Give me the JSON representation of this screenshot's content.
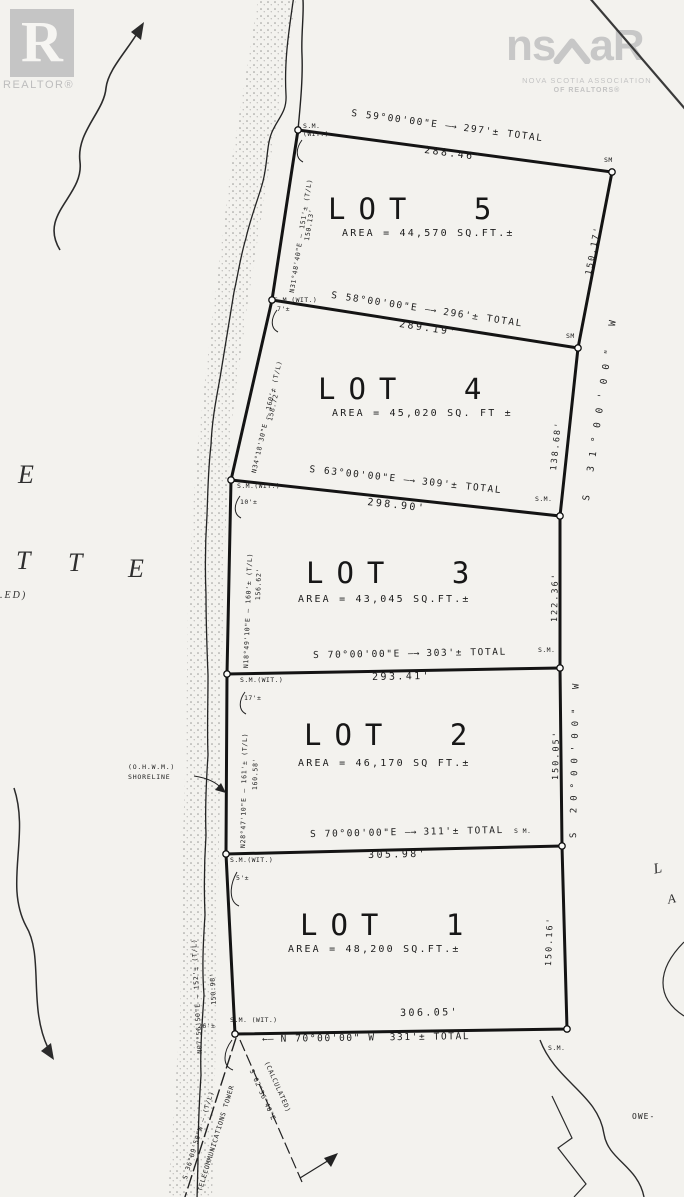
{
  "ui": {
    "arrow_right": "—→",
    "arrow_left": "←—"
  },
  "branding": {
    "realtor_letter": "R",
    "realtor_label": "REALTOR®",
    "nsar_left": "ns",
    "nsar_right": "aR",
    "nsar_line1": "NOVA SCOTIA ASSOCIATION",
    "nsar_line2": "OF REALTORS®"
  },
  "margin": {
    "e1": "E",
    "t1": "T",
    "t2": "T",
    "e2": "E",
    "ed": ".ED)",
    "l": "L",
    "a": "A",
    "owe": "OWE-"
  },
  "shoreline": {
    "line1": "(O.H.W.M.)",
    "line2": "SHORELINE"
  },
  "lots": [
    {
      "name": "LOT 5",
      "area": "AREA = 44,570 SQ.FT.±",
      "bearing": "S 59°00'00\"E",
      "total": "297'± TOTAL",
      "measured": "288.46'",
      "nw_marker": "S.M.",
      "nw_marker2": "(WIT.)",
      "ne_marker": "SM",
      "east_measured": "150.17'",
      "west_bearing": "N31°48'40\"E — 151'± (T/L)",
      "west_measured": "150.13'"
    },
    {
      "name": "LOT 4",
      "area": "AREA = 45,020 SQ. FT ±",
      "bearing": "S 58°00'00\"E",
      "total": "296'± TOTAL",
      "measured": "289.19'",
      "nw_marker": "S.M.(WIT.)",
      "nw_offset": "7'±",
      "ne_marker": "SM",
      "east_measured": "138.68'",
      "east_bearing": "S 31°00'00\" W",
      "west_bearing": "N34°18'30\"E — 160'± (T/L)",
      "west_measured": "158.72'"
    },
    {
      "name": "LOT 3",
      "area": "AREA = 43,045 SQ.FT.±",
      "bearing": "S 63°00'00\"E",
      "total": "309'± TOTAL",
      "measured": "298.90'",
      "nw_marker": "S.M.(WIT.)",
      "nw_offset": "10'±",
      "ne_marker": "S.M.",
      "east_measured": "122.36'",
      "west_bearing": "N18°49'10\"E — 160'± (T/L)",
      "west_measured": "156.62'"
    },
    {
      "name": "LOT 2",
      "area": "AREA = 46,170 SQ FT.±",
      "bearing": "S 70°00'00\"E",
      "total": "303'± TOTAL",
      "measured": "293.41'",
      "nw_marker": "S.M.(WIT.)",
      "nw_offset": "17'±",
      "ne_marker": "S.M.",
      "east_measured": "150.05'",
      "east_bearing": "S 20°00'00\" W",
      "west_bearing": "N28°47'10\"E — 161'± (T/L)",
      "west_measured": "160.58'"
    },
    {
      "name": "LOT 1",
      "area": "AREA = 48,200 SQ.FT.±",
      "bearing": "S 70°00'00\"E",
      "total": "311'± TOTAL",
      "measured": "305.98'",
      "nw_marker": "S.M.(WIT.)",
      "nw_offset": "5'±",
      "ne_marker": "S M.",
      "east_measured": "150.16'",
      "west_bearing": "N07°56'50\"E — 152'± (T/L)",
      "west_measured": "150.98'"
    }
  ],
  "south": {
    "measured": "306.05'",
    "bearing": "N 70°00'00\" W",
    "total": "331'± TOTAL",
    "right_marker": "S.M.",
    "left_marker": "S.M. (WIT.)",
    "left_offset": "26'±"
  },
  "references": {
    "tower_bearing": "S 36°09'50\"W — (T/L)",
    "tower_label": "TELECOMMUNICATIONS TOWER",
    "calc_bearing": "S 02°36'40\"E",
    "calc_label": "(CALCULATED)"
  }
}
